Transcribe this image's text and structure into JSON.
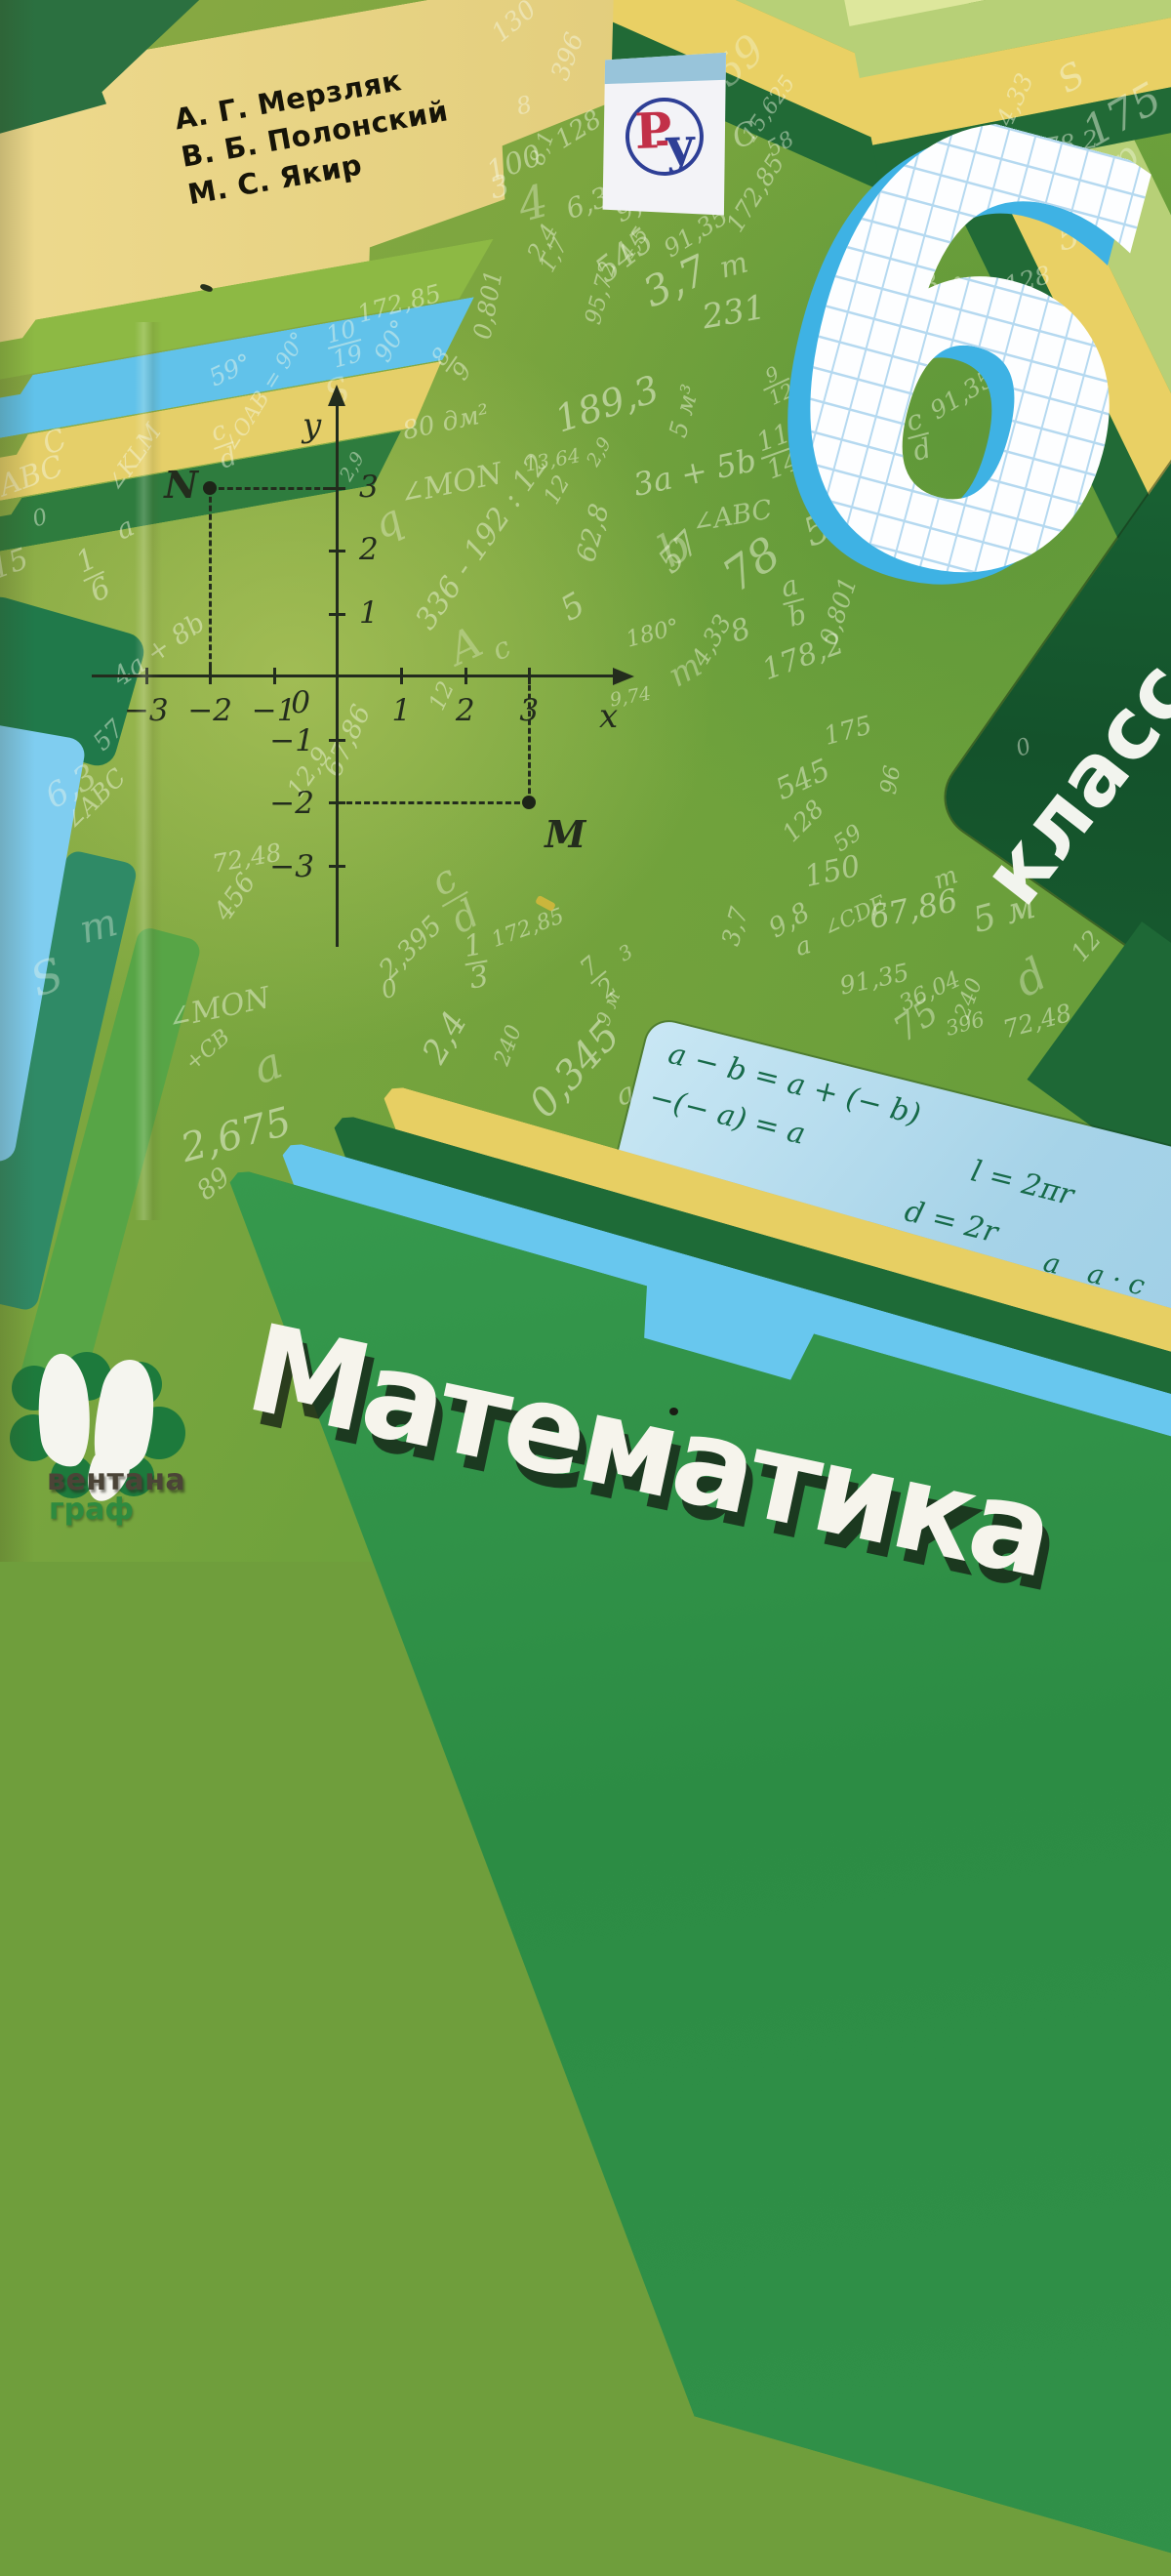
{
  "cover": {
    "authors": [
      "А. Г. Мерзляк",
      "В. Б. Полонский",
      "М. С. Якир"
    ],
    "grade_number": "6",
    "grade_word": "класс",
    "title": "Математика",
    "publisher": {
      "line1": "вентана",
      "line2": "граф"
    },
    "badge": {
      "letter_r": "Р",
      "letter_u": "у"
    }
  },
  "colors": {
    "base_green": "#7ca63f",
    "dark_green_panel": "#14522b",
    "title_panel_green": "#319149",
    "band_yellow": "#e7cf63",
    "band_blue": "#68c7ee",
    "band_dark_green": "#1e6b37",
    "author_band_tan": "#e8d78a",
    "formula_panel_blue": "#a6d3e8",
    "formula_ink_green": "#176a49",
    "grid_blue": "#3eb2e4",
    "badge_red": "#c23048",
    "badge_blue": "#2e3f96",
    "scribble_white": "#f7fbe9"
  },
  "plane": {
    "x_label": "x",
    "y_label": "y",
    "origin_label": "0",
    "x_ticks": [
      {
        "v": -3,
        "label": "−3"
      },
      {
        "v": -2,
        "label": "−2"
      },
      {
        "v": -1,
        "label": "−1"
      },
      {
        "v": 1,
        "label": "1"
      },
      {
        "v": 2,
        "label": "2"
      },
      {
        "v": 3,
        "label": "3"
      }
    ],
    "y_ticks": [
      {
        "v": 3,
        "label": "3"
      },
      {
        "v": 2,
        "label": "2"
      },
      {
        "v": 1,
        "label": "1"
      },
      {
        "v": -1,
        "label": "−1"
      },
      {
        "v": -2,
        "label": "−2"
      },
      {
        "v": -3,
        "label": "−3"
      }
    ],
    "points": [
      {
        "name": "N",
        "x": -2,
        "y": 3,
        "lx": -47,
        "ly": -26
      },
      {
        "name": "M",
        "x": 3,
        "y": -2,
        "ly": 10,
        "lx": 16
      }
    ]
  },
  "formulas": {
    "items": [
      {
        "x": 26,
        "y": 14,
        "s": 30,
        "seg": [
          {
            "t": "a − b = a + (− b)"
          }
        ]
      },
      {
        "x": 18,
        "y": 62,
        "s": 30,
        "seg": [
          {
            "t": "−(− a) = a"
          }
        ]
      },
      {
        "x": 356,
        "y": 56,
        "s": 30,
        "seg": [
          {
            "t": "l = 2πr"
          }
        ]
      },
      {
        "x": 300,
        "y": 112,
        "s": 30,
        "seg": [
          {
            "t": "d = 2r"
          }
        ]
      },
      {
        "x": 16,
        "y": 140,
        "s": 28,
        "seg": [
          {
            "fr": [
              "a",
              "b"
            ]
          },
          {
            "t": " · "
          },
          {
            "fr": [
              "c",
              "d"
            ]
          },
          {
            "t": " = "
          },
          {
            "fr": [
              "a · c",
              "b · d"
            ]
          }
        ]
      },
      {
        "x": 246,
        "y": 190,
        "s": 30,
        "seg": [
          {
            "t": "|a| = |−a|"
          }
        ]
      },
      {
        "x": 448,
        "y": 132,
        "s": 28,
        "seg": [
          {
            "fr": [
              "a",
              "b"
            ]
          },
          {
            "t": " = "
          },
          {
            "fr": [
              "a · c",
              "b · d"
            ]
          }
        ]
      },
      {
        "x": 448,
        "y": 226,
        "s": 28,
        "seg": [
          {
            "fr": [
              "a",
              "b"
            ]
          },
          {
            "t": " : "
          },
          {
            "fr": [
              "c",
              "d"
            ]
          },
          {
            "t": " ="
          }
        ]
      }
    ]
  },
  "scribbles": [
    {
      "t": "130",
      "x": 527,
      "y": 22,
      "s": 26,
      "r": -40
    },
    {
      "t": "396",
      "x": 582,
      "y": 58,
      "s": 26,
      "r": -70
    },
    {
      "t": "100",
      "x": 527,
      "y": 168,
      "s": 30,
      "r": -20
    },
    {
      "t": "8",
      "x": 537,
      "y": 108,
      "s": 24,
      "r": -15
    },
    {
      "t": "545",
      "x": 640,
      "y": 262,
      "s": 34,
      "r": -38
    },
    {
      "t": "128",
      "x": 593,
      "y": 133,
      "s": 26,
      "r": -32
    },
    {
      "t": "8,1",
      "x": 556,
      "y": 152,
      "s": 22,
      "r": -70
    },
    {
      "t": "4",
      "x": 546,
      "y": 208,
      "s": 46,
      "r": -15,
      "o": 0.35
    },
    {
      "t": "3",
      "x": 512,
      "y": 192,
      "s": 30,
      "r": -15
    },
    {
      "t": "2,4",
      "x": 556,
      "y": 248,
      "s": 24,
      "r": -62
    },
    {
      "t": "1,7",
      "x": 568,
      "y": 262,
      "s": 22,
      "r": -62
    },
    {
      "t": "6,3",
      "x": 602,
      "y": 208,
      "s": 28,
      "r": -20
    },
    {
      "t": "9,8",
      "x": 652,
      "y": 210,
      "s": 28,
      "r": -25
    },
    {
      "t": "4,5",
      "x": 650,
      "y": 250,
      "s": 22,
      "r": -55
    },
    {
      "t": "95,72",
      "x": 616,
      "y": 300,
      "s": 23,
      "r": -75
    },
    {
      "t": "0,801",
      "x": 500,
      "y": 312,
      "s": 25,
      "r": -80
    },
    {
      "t": "3,7",
      "x": 692,
      "y": 288,
      "s": 42,
      "r": -25,
      "o": 0.5
    },
    {
      "t": "231",
      "x": 752,
      "y": 320,
      "s": 34,
      "r": -10,
      "o": 0.5
    },
    {
      "t": "m",
      "x": 752,
      "y": 272,
      "s": 30,
      "r": -15
    },
    {
      "t": "91,35",
      "x": 713,
      "y": 238,
      "s": 25,
      "r": -32
    },
    {
      "t": "172,85",
      "x": 774,
      "y": 198,
      "s": 25,
      "r": -58
    },
    {
      "t": "15,625",
      "x": 788,
      "y": 112,
      "s": 22,
      "r": -55
    },
    {
      "t": "58",
      "x": 800,
      "y": 148,
      "s": 22,
      "r": -30
    },
    {
      "t": "C",
      "x": 763,
      "y": 138,
      "s": 32,
      "r": -20
    },
    {
      "t": "59",
      "x": 757,
      "y": 62,
      "s": 42,
      "r": -42,
      "o": 0.35
    },
    {
      "t": "4,33",
      "x": 1040,
      "y": 102,
      "s": 25,
      "r": -65
    },
    {
      "t": "S",
      "x": 1098,
      "y": 80,
      "s": 36,
      "r": -30
    },
    {
      "t": "175",
      "x": 1150,
      "y": 118,
      "s": 44,
      "r": -30
    },
    {
      "t": "p",
      "x": 1152,
      "y": 162,
      "s": 38,
      "r": -42,
      "o": 0.4
    },
    {
      "t": "178,2",
      "x": 1090,
      "y": 148,
      "s": 25,
      "r": -10
    },
    {
      "t": "a",
      "x": 1008,
      "y": 152,
      "s": 34,
      "r": -20
    },
    {
      "t": "545",
      "x": 1116,
      "y": 238,
      "s": 34,
      "r": -15
    },
    {
      "t": "128",
      "x": 1053,
      "y": 287,
      "s": 25,
      "r": -15
    },
    {
      "t": "8,1",
      "x": 946,
      "y": 258,
      "s": 25,
      "r": -65
    },
    {
      "t": "6,3",
      "x": 941,
      "y": 296,
      "s": 28,
      "r": -20
    },
    {
      "t": "m",
      "x": 977,
      "y": 291,
      "s": 24,
      "r": -30
    },
    {
      "t": "91,35",
      "x": 986,
      "y": 404,
      "s": 25,
      "r": -32
    },
    {
      "f": [
        "c",
        "d"
      ],
      "x": 941,
      "y": 446,
      "s": 28,
      "r": -15
    },
    {
      "t": "172,85",
      "x": 409,
      "y": 311,
      "s": 25,
      "r": -15
    },
    {
      "t": "59°",
      "x": 236,
      "y": 379,
      "s": 25,
      "r": -25
    },
    {
      "t": "∠OAB = 90°",
      "x": 272,
      "y": 402,
      "s": 22,
      "r": -58
    },
    {
      "t": "90°",
      "x": 401,
      "y": 349,
      "s": 25,
      "r": -60
    },
    {
      "f": [
        "10",
        "19"
      ],
      "x": 353,
      "y": 353,
      "s": 24,
      "r": -15
    },
    {
      "f": [
        "8",
        "9"
      ],
      "x": 463,
      "y": 373,
      "s": 24,
      "r": -55
    },
    {
      "t": "S",
      "x": 346,
      "y": 402,
      "s": 36,
      "r": -20,
      "o": 0.35
    },
    {
      "t": "80 дм²",
      "x": 457,
      "y": 433,
      "s": 26,
      "r": -12
    },
    {
      "t": "13,64",
      "x": 566,
      "y": 471,
      "s": 20,
      "r": -10
    },
    {
      "t": "∠MON",
      "x": 462,
      "y": 496,
      "s": 30,
      "r": -12
    },
    {
      "t": "189,3",
      "x": 622,
      "y": 414,
      "s": 38,
      "r": -18,
      "o": 0.5
    },
    {
      "t": "2,9",
      "x": 361,
      "y": 478,
      "s": 19,
      "r": -60
    },
    {
      "t": "2,9",
      "x": 614,
      "y": 463,
      "s": 19,
      "r": -60
    },
    {
      "t": "336 - 192 : 12",
      "x": 494,
      "y": 555,
      "s": 30,
      "r": -55
    },
    {
      "t": "62,8",
      "x": 608,
      "y": 546,
      "s": 27,
      "r": -75
    },
    {
      "t": "57",
      "x": 696,
      "y": 566,
      "s": 34,
      "r": -45
    },
    {
      "t": "q",
      "x": 397,
      "y": 534,
      "s": 42,
      "r": -25,
      "o": 0.35
    },
    {
      "t": "A",
      "x": 477,
      "y": 662,
      "s": 44,
      "r": -25,
      "o": 0.3
    },
    {
      "t": "c",
      "x": 514,
      "y": 665,
      "s": 30,
      "r": -25,
      "o": 0.35
    },
    {
      "t": "5",
      "x": 587,
      "y": 622,
      "s": 34,
      "r": -30
    },
    {
      "t": "m",
      "x": 702,
      "y": 687,
      "s": 34,
      "r": -30,
      "o": 0.35
    },
    {
      "t": "12",
      "x": 571,
      "y": 502,
      "s": 23,
      "r": -60
    },
    {
      "f": [
        "11",
        "14"
      ],
      "x": 798,
      "y": 463,
      "s": 27,
      "r": -20
    },
    {
      "f": [
        "9",
        "12"
      ],
      "x": 796,
      "y": 394,
      "s": 20,
      "r": -25
    },
    {
      "t": "5 м³",
      "x": 701,
      "y": 421,
      "s": 25,
      "r": -75
    },
    {
      "t": "3a + 5b",
      "x": 712,
      "y": 484,
      "s": 32,
      "r": -12,
      "o": 0.5
    },
    {
      "t": "∠ABC",
      "x": 750,
      "y": 529,
      "s": 27,
      "r": -10
    },
    {
      "t": "59",
      "x": 849,
      "y": 538,
      "s": 40,
      "r": -25,
      "o": 0.45
    },
    {
      "t": "78",
      "x": 770,
      "y": 578,
      "s": 46,
      "r": -35,
      "o": 0.45
    },
    {
      "f": [
        "a",
        "b"
      ],
      "x": 813,
      "y": 616,
      "s": 28,
      "r": -15
    },
    {
      "t": "b",
      "x": 691,
      "y": 561,
      "s": 46,
      "r": -30,
      "o": 0.35
    },
    {
      "t": "0,801",
      "x": 859,
      "y": 626,
      "s": 25,
      "r": -72
    },
    {
      "t": "178,2",
      "x": 823,
      "y": 673,
      "s": 30,
      "r": -20
    },
    {
      "t": "8",
      "x": 759,
      "y": 646,
      "s": 30,
      "r": -20
    },
    {
      "t": "4,33",
      "x": 729,
      "y": 656,
      "s": 25,
      "r": -60
    },
    {
      "t": "180°",
      "x": 669,
      "y": 649,
      "s": 23,
      "r": -15
    },
    {
      "t": "9,74",
      "x": 646,
      "y": 714,
      "s": 19,
      "r": -10
    },
    {
      "t": "12",
      "x": 453,
      "y": 713,
      "s": 23,
      "r": -65
    },
    {
      "t": "67,86",
      "x": 356,
      "y": 759,
      "s": 27,
      "r": -65
    },
    {
      "t": "12,9",
      "x": 316,
      "y": 791,
      "s": 25,
      "r": -55
    },
    {
      "t": "72,48",
      "x": 253,
      "y": 879,
      "s": 25,
      "r": -10
    },
    {
      "t": "∠ABC",
      "x": 97,
      "y": 819,
      "s": 25,
      "r": -45
    },
    {
      "t": "6,3",
      "x": 73,
      "y": 806,
      "s": 34,
      "r": -30,
      "o": 0.4
    },
    {
      "t": "57",
      "x": 111,
      "y": 753,
      "s": 25,
      "r": -45
    },
    {
      "t": "C",
      "x": 56,
      "y": 453,
      "s": 30,
      "r": -25
    },
    {
      "t": "ABC",
      "x": 32,
      "y": 488,
      "s": 30,
      "r": -20
    },
    {
      "t": "0",
      "x": 41,
      "y": 531,
      "s": 23,
      "r": -15
    },
    {
      "t": "15",
      "x": 10,
      "y": 578,
      "s": 30,
      "r": -20
    },
    {
      "f": [
        "1",
        "6"
      ],
      "x": 96,
      "y": 590,
      "s": 30,
      "r": -25
    },
    {
      "t": "a",
      "x": 128,
      "y": 541,
      "s": 28,
      "r": -25
    },
    {
      "t": "∠KLM",
      "x": 137,
      "y": 469,
      "s": 24,
      "r": -55
    },
    {
      "f": [
        "c",
        "d"
      ],
      "x": 229,
      "y": 456,
      "s": 26,
      "r": -20
    },
    {
      "t": "4a + 8b",
      "x": 163,
      "y": 666,
      "s": 27,
      "r": -35
    },
    {
      "t": "S",
      "x": 48,
      "y": 1001,
      "s": 46,
      "r": -20,
      "o": 0.35
    },
    {
      "t": "m",
      "x": 101,
      "y": 949,
      "s": 40,
      "r": -15,
      "o": 0.35
    },
    {
      "t": "456",
      "x": 241,
      "y": 919,
      "s": 27,
      "r": -55
    },
    {
      "t": "∠MON",
      "x": 224,
      "y": 1033,
      "s": 30,
      "r": -12
    },
    {
      "t": "a",
      "x": 274,
      "y": 1091,
      "s": 46,
      "r": -20,
      "o": 0.35
    },
    {
      "t": "+CB",
      "x": 213,
      "y": 1076,
      "s": 22,
      "r": -40
    },
    {
      "t": "2,675",
      "x": 242,
      "y": 1163,
      "s": 40,
      "r": -15,
      "o": 0.5
    },
    {
      "t": "89",
      "x": 219,
      "y": 1213,
      "s": 27,
      "r": -40
    },
    {
      "t": "2,395",
      "x": 421,
      "y": 971,
      "s": 27,
      "r": -45
    },
    {
      "f": [
        "1",
        "3"
      ],
      "x": 488,
      "y": 986,
      "s": 30,
      "r": -10
    },
    {
      "t": "0",
      "x": 399,
      "y": 1013,
      "s": 25,
      "r": -15
    },
    {
      "t": "2,4",
      "x": 456,
      "y": 1063,
      "s": 34,
      "r": -60,
      "o": 0.5
    },
    {
      "t": "240",
      "x": 521,
      "y": 1071,
      "s": 22,
      "r": -70
    },
    {
      "t": "0,345",
      "x": 589,
      "y": 1096,
      "s": 40,
      "r": -48,
      "o": 0.5
    },
    {
      "f": [
        "c",
        "d"
      ],
      "x": 466,
      "y": 921,
      "s": 40,
      "r": -30,
      "o": 0.35
    },
    {
      "t": "172,85",
      "x": 541,
      "y": 951,
      "s": 22,
      "r": -20
    },
    {
      "f": [
        "7",
        "2"
      ],
      "x": 613,
      "y": 1001,
      "s": 25,
      "r": -40
    },
    {
      "t": "3",
      "x": 641,
      "y": 976,
      "s": 20,
      "r": -30
    },
    {
      "t": "9 м",
      "x": 623,
      "y": 1033,
      "s": 20,
      "r": -70
    },
    {
      "t": "a",
      "x": 641,
      "y": 1121,
      "s": 30,
      "r": -20
    },
    {
      "t": "91,35",
      "x": 896,
      "y": 1003,
      "s": 25,
      "r": -12
    },
    {
      "t": "36,04",
      "x": 953,
      "y": 1016,
      "s": 23,
      "r": -25
    },
    {
      "t": "240",
      "x": 993,
      "y": 1023,
      "s": 22,
      "r": -70
    },
    {
      "t": "75",
      "x": 939,
      "y": 1046,
      "s": 36,
      "r": -35,
      "o": 0.4
    },
    {
      "t": "396",
      "x": 989,
      "y": 1049,
      "s": 21,
      "r": -15
    },
    {
      "t": "72,48",
      "x": 1063,
      "y": 1046,
      "s": 25,
      "r": -15
    },
    {
      "t": "d",
      "x": 1056,
      "y": 1001,
      "s": 46,
      "r": -30,
      "o": 0.35
    },
    {
      "t": "12",
      "x": 1113,
      "y": 969,
      "s": 25,
      "r": -50
    },
    {
      "t": "67",
      "x": 1156,
      "y": 1019,
      "s": 25,
      "r": -25
    },
    {
      "t": "9,8",
      "x": 809,
      "y": 943,
      "s": 27,
      "r": -30
    },
    {
      "t": "3,7",
      "x": 753,
      "y": 949,
      "s": 25,
      "r": -75
    },
    {
      "t": "∠CDE",
      "x": 876,
      "y": 939,
      "s": 22,
      "r": -25
    },
    {
      "t": "a",
      "x": 823,
      "y": 969,
      "s": 25,
      "r": -15
    },
    {
      "t": "150",
      "x": 853,
      "y": 893,
      "s": 30,
      "r": -12
    },
    {
      "t": "67,86",
      "x": 936,
      "y": 931,
      "s": 32,
      "r": -12,
      "o": 0.5
    },
    {
      "t": "5 м",
      "x": 1029,
      "y": 936,
      "s": 36,
      "r": -15,
      "o": 0.45
    },
    {
      "t": "m",
      "x": 969,
      "y": 899,
      "s": 25,
      "r": -20
    },
    {
      "t": "96",
      "x": 913,
      "y": 799,
      "s": 23,
      "r": -80
    },
    {
      "t": "545",
      "x": 823,
      "y": 799,
      "s": 30,
      "r": -25
    },
    {
      "t": "128",
      "x": 823,
      "y": 841,
      "s": 25,
      "r": -45
    },
    {
      "t": "59",
      "x": 869,
      "y": 859,
      "s": 23,
      "r": -35
    },
    {
      "t": "175",
      "x": 869,
      "y": 749,
      "s": 26,
      "r": -15
    },
    {
      "t": "0",
      "x": 1049,
      "y": 766,
      "s": 23,
      "r": -20
    }
  ]
}
